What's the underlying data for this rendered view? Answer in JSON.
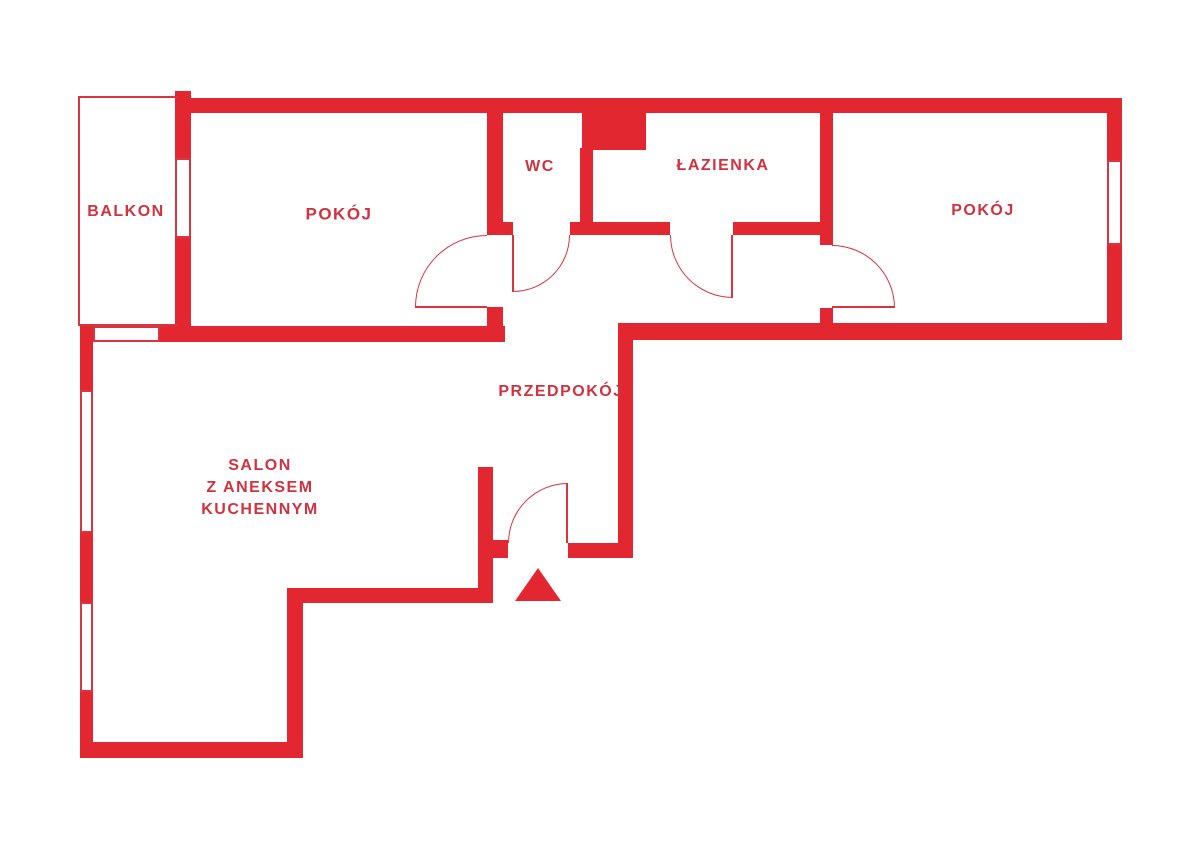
{
  "plan": {
    "type": "floor-plan",
    "canvas": {
      "width": 1200,
      "height": 850
    },
    "colors": {
      "wall": "#e32730",
      "thin_line": "#d7353f",
      "label_text": "#cf3340",
      "background": "#ffffff"
    },
    "labels": [
      {
        "id": "balkon",
        "text": "BALKON",
        "cx": 126,
        "cy": 212,
        "size": 16
      },
      {
        "id": "pokoj-left",
        "text": "POKÓJ",
        "cx": 339,
        "cy": 214,
        "size": 17
      },
      {
        "id": "wc",
        "text": "WC",
        "cx": 540,
        "cy": 167,
        "size": 16
      },
      {
        "id": "lazienka",
        "text": "ŁAZIENKA",
        "cx": 723,
        "cy": 166,
        "size": 16
      },
      {
        "id": "pokoj-right",
        "text": "POKÓJ",
        "cx": 983,
        "cy": 211,
        "size": 16
      },
      {
        "id": "przedpokoj",
        "text": "PRZEDPOKÓJ",
        "cx": 561,
        "cy": 392,
        "size": 16
      },
      {
        "id": "salon",
        "text": "SALON\nZ ANEKSEM\nKUCHENNYM",
        "cx": 260,
        "cy": 488,
        "size": 16
      }
    ],
    "walls": [
      {
        "x": 175,
        "y": 98,
        "w": 947,
        "h": 15
      },
      {
        "x": 175,
        "y": 91,
        "w": 16,
        "h": 67
      },
      {
        "x": 175,
        "y": 238,
        "w": 16,
        "h": 92
      },
      {
        "x": 1107,
        "y": 98,
        "w": 15,
        "h": 62
      },
      {
        "x": 1107,
        "y": 245,
        "w": 15,
        "h": 95
      },
      {
        "x": 80,
        "y": 326,
        "w": 13,
        "h": 64
      },
      {
        "x": 160,
        "y": 326,
        "w": 345,
        "h": 16
      },
      {
        "x": 80,
        "y": 533,
        "w": 13,
        "h": 69
      },
      {
        "x": 80,
        "y": 692,
        "w": 13,
        "h": 66
      },
      {
        "x": 80,
        "y": 742,
        "w": 223,
        "h": 16
      },
      {
        "x": 287,
        "y": 588,
        "w": 16,
        "h": 170
      },
      {
        "x": 303,
        "y": 588,
        "w": 190,
        "h": 15
      },
      {
        "x": 478,
        "y": 467,
        "w": 15,
        "h": 136
      },
      {
        "x": 493,
        "y": 540,
        "w": 15,
        "h": 18
      },
      {
        "x": 568,
        "y": 543,
        "w": 65,
        "h": 15
      },
      {
        "x": 618,
        "y": 340,
        "w": 15,
        "h": 218
      },
      {
        "x": 618,
        "y": 323,
        "w": 504,
        "h": 17
      },
      {
        "x": 487,
        "y": 98,
        "w": 16,
        "h": 137
      },
      {
        "x": 487,
        "y": 307,
        "w": 16,
        "h": 35
      },
      {
        "x": 580,
        "y": 148,
        "w": 13,
        "h": 87
      },
      {
        "x": 582,
        "y": 105,
        "w": 64,
        "h": 45
      },
      {
        "x": 487,
        "y": 222,
        "w": 26,
        "h": 13
      },
      {
        "x": 570,
        "y": 222,
        "w": 100,
        "h": 13
      },
      {
        "x": 733,
        "y": 222,
        "w": 87,
        "h": 13
      },
      {
        "x": 820,
        "y": 98,
        "w": 13,
        "h": 147
      },
      {
        "x": 820,
        "y": 308,
        "w": 13,
        "h": 20
      }
    ],
    "windows": [
      {
        "x": 175,
        "y": 158,
        "w": 16,
        "h": 80
      },
      {
        "x": 93,
        "y": 326,
        "w": 67,
        "h": 16
      },
      {
        "x": 80,
        "y": 390,
        "w": 13,
        "h": 143
      },
      {
        "x": 80,
        "y": 602,
        "w": 13,
        "h": 90
      },
      {
        "x": 1107,
        "y": 160,
        "w": 15,
        "h": 85
      }
    ],
    "balcony_outline": {
      "x": 78,
      "y": 96,
      "w": 100,
      "h": 230
    },
    "doors": [
      {
        "id": "door-pokoj-left",
        "x": 415,
        "y": 235,
        "w": 72,
        "h": 72,
        "corner": "tl",
        "leaf": {
          "x": 415,
          "y": 306,
          "w": 72,
          "h": 2
        }
      },
      {
        "id": "door-wc",
        "x": 513,
        "y": 235,
        "w": 57,
        "h": 57,
        "corner": "br",
        "leaf": {
          "x": 512,
          "y": 235,
          "w": 2,
          "h": 57
        }
      },
      {
        "id": "door-lazienka",
        "x": 670,
        "y": 235,
        "w": 63,
        "h": 63,
        "corner": "bl",
        "leaf": {
          "x": 731,
          "y": 235,
          "w": 2,
          "h": 63
        }
      },
      {
        "id": "door-pokoj-right",
        "x": 832,
        "y": 245,
        "w": 63,
        "h": 63,
        "corner": "tr",
        "leaf": {
          "x": 832,
          "y": 306,
          "w": 63,
          "h": 2
        }
      },
      {
        "id": "door-entrance",
        "x": 508,
        "y": 483,
        "w": 60,
        "h": 60,
        "corner": "tl",
        "leaf": {
          "x": 566,
          "y": 483,
          "w": 2,
          "h": 60
        }
      }
    ],
    "entrance_marker": {
      "x": 515,
      "y": 568,
      "half_base": 23,
      "height": 33,
      "direction": "up"
    }
  }
}
